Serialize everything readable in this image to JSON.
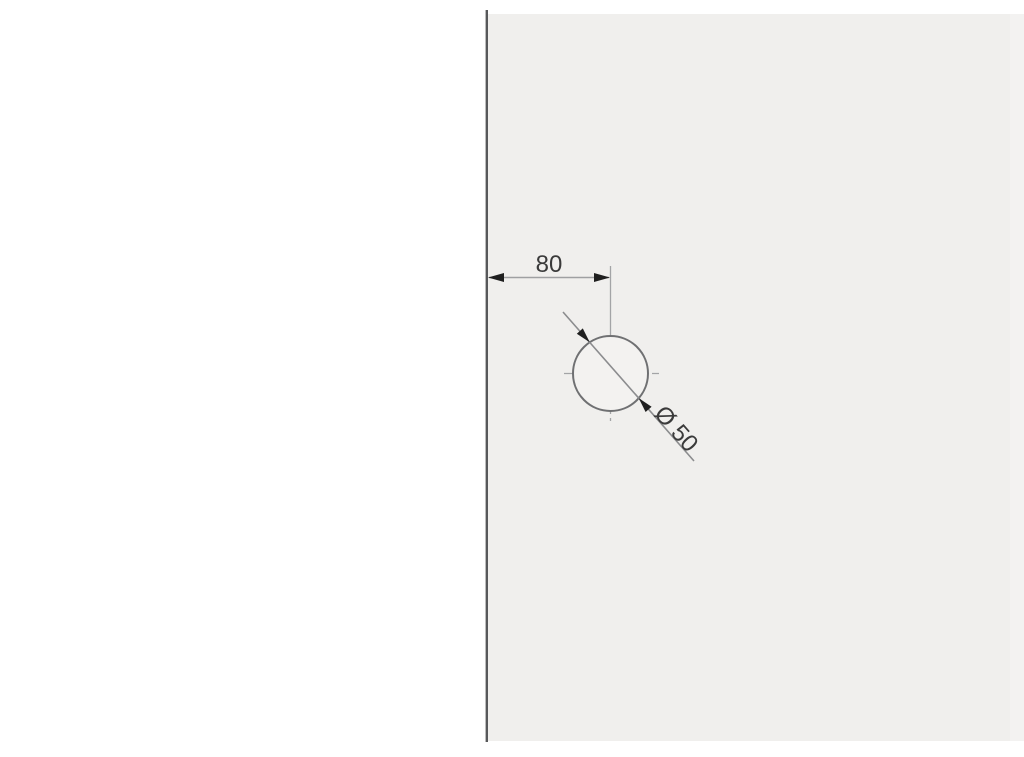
{
  "drawing": {
    "type": "technical-dimension-drawing",
    "edge_dimension": {
      "label": "80",
      "value": 80
    },
    "diameter_dimension": {
      "label": "Ø 50",
      "value": 50
    },
    "colors": {
      "canvas": "#ffffff",
      "panel": "#f0efed",
      "panel_edge": "#57585a",
      "dim_line": "#9fa0a2",
      "centerline": "#a3a4a6",
      "circle_stroke": "#6f7072",
      "circle_fill": "#f3f2f0",
      "leader_line": "#8b8c8e",
      "arrow": "#1f1f1f",
      "text": "#3a3a3a"
    }
  }
}
